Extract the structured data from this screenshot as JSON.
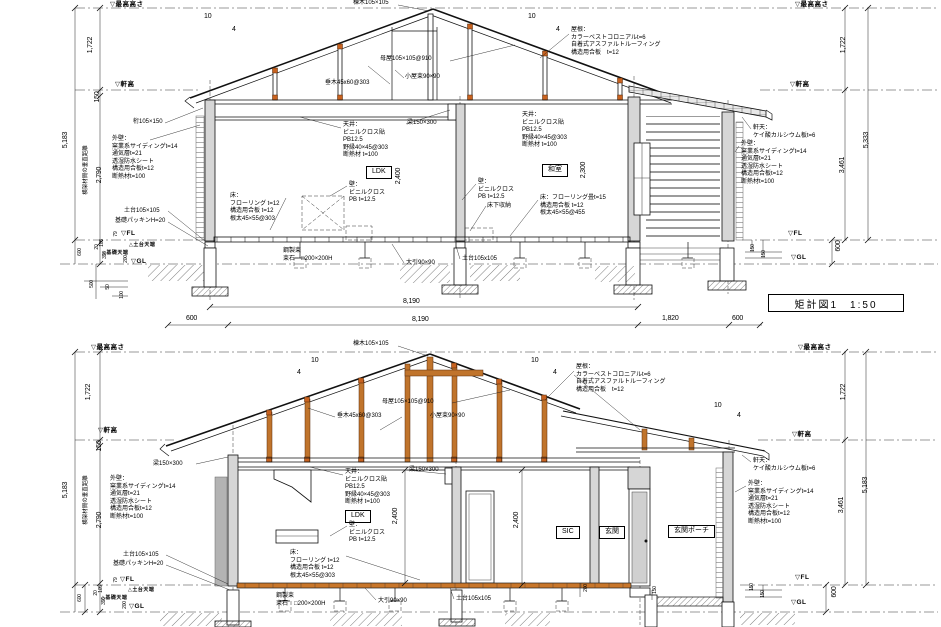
{
  "title_block": {
    "text": "矩計図1　1:50"
  },
  "labels": [
    {
      "n": "level-max-height-left",
      "t": "▽最高高さ",
      "x": 110,
      "y": 1,
      "cls": "level"
    },
    {
      "n": "level-max-height-right",
      "t": "▽最高高さ",
      "x": 795,
      "y": 1,
      "cls": "level"
    },
    {
      "n": "dim-vert",
      "t": "1,722",
      "x": 87,
      "y": 45,
      "rot": 1,
      "cls": "dim"
    },
    {
      "n": "dim-vert",
      "t": "1,722",
      "x": 840,
      "y": 45,
      "rot": 1,
      "cls": "dim"
    },
    {
      "n": "level-eave-left",
      "t": "▽軒高",
      "x": 115,
      "y": 81,
      "cls": "level"
    },
    {
      "n": "level-eave-right",
      "t": "▽軒高",
      "x": 790,
      "y": 81,
      "cls": "level"
    },
    {
      "n": "dim-vert",
      "t": "150",
      "x": 94,
      "y": 97,
      "rot": 1,
      "cls": "dim"
    },
    {
      "n": "dim-vert",
      "t": "5,183",
      "x": 62,
      "y": 140,
      "rot": 1,
      "cls": "dim"
    },
    {
      "n": "note-vert-member-distance",
      "t": "横架材間の垂直距離",
      "x": 83,
      "y": 170,
      "rot": 1,
      "cls": "note",
      "fs": 5.5
    },
    {
      "n": "dim-vert",
      "t": "2,790",
      "x": 96,
      "y": 175,
      "rot": 1,
      "cls": "dim"
    },
    {
      "n": "note-ridge",
      "t": "棟木105×105",
      "x": 353,
      "y": 0,
      "cls": "note"
    },
    {
      "n": "slope-mark",
      "t": "10",
      "x": 204,
      "y": 13,
      "cls": "dim"
    },
    {
      "n": "slope-mark",
      "t": "4",
      "x": 232,
      "y": 26,
      "cls": "dim"
    },
    {
      "n": "slope-mark",
      "t": "10",
      "x": 528,
      "y": 13,
      "cls": "dim"
    },
    {
      "n": "slope-mark",
      "t": "4",
      "x": 556,
      "y": 26,
      "cls": "dim"
    },
    {
      "n": "note-rafter",
      "t": "垂木45x60@303",
      "x": 325,
      "y": 80,
      "cls": "note"
    },
    {
      "n": "note-purlin",
      "t": "母屋105×105@910",
      "x": 380,
      "y": 56,
      "cls": "note"
    },
    {
      "n": "note-roof-post",
      "t": "小屋束90×90",
      "x": 405,
      "y": 74,
      "cls": "note"
    },
    {
      "n": "note-roof-spec",
      "t": "屋根：\nカラーベストコロニアルt=6\n自着式アスファルトルーフィング\n構造用合板　t=12",
      "x": 571,
      "y": 27,
      "cls": "note"
    },
    {
      "n": "note-girder",
      "t": "桁105×150",
      "x": 133,
      "y": 119,
      "cls": "note"
    },
    {
      "n": "note-exterior-wall-left",
      "t": "外壁：\n窯業系サイディングt=14\n通気層t=21\n透湿防水シート\n構造用合板t=12\n断熱材t=100",
      "x": 112,
      "y": 136,
      "cls": "note"
    },
    {
      "n": "note-ceiling-ldk",
      "t": "天井：\nビニルクロス貼\nPB12.5\n野縁40×45@303\n断熱材 t=100",
      "x": 343,
      "y": 122,
      "cls": "note"
    },
    {
      "n": "note-beam",
      "t": "梁150×300",
      "x": 407,
      "y": 120,
      "cls": "note"
    },
    {
      "n": "room-label-ldk",
      "t": "LDK",
      "x": 366,
      "y": 166,
      "cls": "room"
    },
    {
      "n": "note-wall-ldk",
      "t": "壁：\nビニルクロス\nPB t=12.5",
      "x": 349,
      "y": 182,
      "cls": "note"
    },
    {
      "n": "dim-vert",
      "t": "2,400",
      "x": 395,
      "y": 176,
      "rot": 1,
      "cls": "dim"
    },
    {
      "n": "note-floor-ldk",
      "t": "床：\nフローリング t=12\n構造用合板 t=12\n根太45×55@303",
      "x": 230,
      "y": 193,
      "cls": "note"
    },
    {
      "n": "note-ceiling-washitsu",
      "t": "天井：\nビニルクロス貼\nPB12.5\n野縁40×45@303\n断熱材 t=100",
      "x": 522,
      "y": 112,
      "cls": "note"
    },
    {
      "n": "room-label-washitsu",
      "t": "和室",
      "x": 542,
      "y": 164,
      "cls": "room"
    },
    {
      "n": "dim-vert",
      "t": "2,300",
      "x": 580,
      "y": 170,
      "rot": 1,
      "cls": "dim"
    },
    {
      "n": "note-wall-washitsu",
      "t": "壁：\nビニルクロス\nPB t=12.5",
      "x": 478,
      "y": 179,
      "cls": "note"
    },
    {
      "n": "note-underfloor-storage",
      "t": "床下収納",
      "x": 487,
      "y": 203,
      "cls": "note"
    },
    {
      "n": "note-floor-washitsu",
      "t": "床：フローリング畳t=15\n構造用合板 t=12\n根太45×55@455",
      "x": 540,
      "y": 195,
      "cls": "note"
    },
    {
      "n": "note-eave-soffit-right",
      "t": "軒天：\nケイ酸カルシウム板t=6",
      "x": 753,
      "y": 125,
      "cls": "note"
    },
    {
      "n": "note-exterior-wall-right",
      "t": "外壁：\n窯業系サイディングt=14\n通気層t=21\n透湿防水シート\n構造用合板t=12\n断熱材t=100",
      "x": 741,
      "y": 141,
      "cls": "note"
    },
    {
      "n": "note-sill",
      "t": "土台105×105",
      "x": 124,
      "y": 208,
      "cls": "note"
    },
    {
      "n": "note-foundation-packing",
      "t": "基礎パッキンH=20",
      "x": 115,
      "y": 218,
      "cls": "note"
    },
    {
      "n": "level-fl-left",
      "t": "▽FL",
      "x": 121,
      "y": 230,
      "cls": "level"
    },
    {
      "n": "level-sill-top",
      "t": "△土台天端",
      "x": 129,
      "y": 242,
      "cls": "level",
      "fs": 5
    },
    {
      "n": "level-foundation-top",
      "t": "△基礎天端",
      "x": 102,
      "y": 250,
      "cls": "level",
      "fs": 5
    },
    {
      "n": "level-gl-left",
      "t": "▽GL",
      "x": 131,
      "y": 258,
      "cls": "level"
    },
    {
      "n": "dim-vert",
      "t": "79",
      "x": 113,
      "y": 234,
      "rot": 1,
      "cls": "dim",
      "fs": 5
    },
    {
      "n": "dim-vert",
      "t": "105",
      "x": 99,
      "y": 243,
      "rot": 1,
      "cls": "dim",
      "fs": 5
    },
    {
      "n": "dim-vert",
      "t": "20",
      "x": 94,
      "y": 247,
      "rot": 1,
      "cls": "dim",
      "fs": 5
    },
    {
      "n": "dim-vert",
      "t": "396",
      "x": 102,
      "y": 255,
      "rot": 1,
      "cls": "dim",
      "fs": 5
    },
    {
      "n": "dim-vert",
      "t": "600",
      "x": 77,
      "y": 252,
      "rot": 1,
      "cls": "dim",
      "fs": 5
    },
    {
      "n": "dim-vert",
      "t": "200",
      "x": 123,
      "y": 259,
      "rot": 1,
      "cls": "dim",
      "fs": 5
    },
    {
      "n": "dim-vert",
      "t": "500",
      "x": 89,
      "y": 284,
      "rot": 1,
      "cls": "dim",
      "fs": 5
    },
    {
      "n": "dim-vert",
      "t": "50",
      "x": 105,
      "y": 287,
      "rot": 1,
      "cls": "dim",
      "fs": 5
    },
    {
      "n": "dim-vert",
      "t": "100",
      "x": 119,
      "y": 295,
      "rot": 1,
      "cls": "dim",
      "fs": 5
    },
    {
      "n": "note-steel-post",
      "t": "鋼製束",
      "x": 283,
      "y": 248,
      "cls": "note"
    },
    {
      "n": "note-post-stone",
      "t": "束石　□200×200H",
      "x": 283,
      "y": 256,
      "cls": "note"
    },
    {
      "n": "note-sleeper",
      "t": "大引90×90",
      "x": 406,
      "y": 260,
      "cls": "note"
    },
    {
      "n": "note-sill-center",
      "t": "土台105x105",
      "x": 462,
      "y": 256,
      "cls": "note"
    },
    {
      "n": "level-fl-right",
      "t": "▽FL",
      "x": 788,
      "y": 230,
      "cls": "level"
    },
    {
      "n": "level-gl-right",
      "t": "▽GL",
      "x": 791,
      "y": 254,
      "cls": "level"
    },
    {
      "n": "dim-vert",
      "t": "600",
      "x": 835,
      "y": 246,
      "rot": 1,
      "cls": "dim"
    },
    {
      "n": "dim-vert",
      "t": "150",
      "x": 750,
      "y": 248,
      "rot": 1,
      "cls": "dim",
      "fs": 5
    },
    {
      "n": "dim-vert",
      "t": "150",
      "x": 761,
      "y": 254,
      "rot": 1,
      "cls": "dim",
      "fs": 5
    },
    {
      "n": "dim-vert",
      "t": "5,333",
      "x": 863,
      "y": 140,
      "rot": 1,
      "cls": "dim"
    },
    {
      "n": "dim-vert",
      "t": "3,461",
      "x": 839,
      "y": 165,
      "rot": 1,
      "cls": "dim"
    },
    {
      "n": "dim-horiz",
      "t": "8,190",
      "x": 403,
      "y": 298,
      "cls": "dim"
    },
    {
      "n": "dim-horiz",
      "t": "600",
      "x": 186,
      "y": 315,
      "cls": "dim"
    },
    {
      "n": "dim-horiz",
      "t": "8,190",
      "x": 412,
      "y": 316,
      "cls": "dim"
    },
    {
      "n": "dim-horiz",
      "t": "1,820",
      "x": 662,
      "y": 315,
      "cls": "dim"
    },
    {
      "n": "dim-horiz",
      "t": "600",
      "x": 732,
      "y": 315,
      "cls": "dim"
    },
    {
      "n": "note-ridge",
      "t": "棟木105×105",
      "x": 353,
      "y": 341,
      "cls": "note"
    },
    {
      "n": "level-max-height-left",
      "t": "▽最高高さ",
      "x": 91,
      "y": 344,
      "cls": "level"
    },
    {
      "n": "level-max-height-right",
      "t": "▽最高高さ",
      "x": 798,
      "y": 344,
      "cls": "level"
    },
    {
      "n": "dim-vert",
      "t": "1,722",
      "x": 85,
      "y": 392,
      "rot": 1,
      "cls": "dim"
    },
    {
      "n": "dim-vert",
      "t": "1,722",
      "x": 840,
      "y": 392,
      "rot": 1,
      "cls": "dim"
    },
    {
      "n": "level-eave-left",
      "t": "▽軒高",
      "x": 98,
      "y": 427,
      "cls": "level"
    },
    {
      "n": "level-eave-right",
      "t": "▽軒高",
      "x": 792,
      "y": 431,
      "cls": "level"
    },
    {
      "n": "dim-vert",
      "t": "150",
      "x": 96,
      "y": 446,
      "rot": 1,
      "cls": "dim"
    },
    {
      "n": "dim-vert",
      "t": "5,183",
      "x": 62,
      "y": 490,
      "rot": 1,
      "cls": "dim"
    },
    {
      "n": "dim-vert",
      "t": "5,183",
      "x": 862,
      "y": 485,
      "rot": 1,
      "cls": "dim"
    },
    {
      "n": "dim-vert",
      "t": "3,461",
      "x": 838,
      "y": 505,
      "rot": 1,
      "cls": "dim"
    },
    {
      "n": "note-vert-member-distance",
      "t": "横架材間の垂直距離",
      "x": 83,
      "y": 500,
      "rot": 1,
      "cls": "note",
      "fs": 5.5
    },
    {
      "n": "dim-vert",
      "t": "2,790",
      "x": 96,
      "y": 520,
      "rot": 1,
      "cls": "dim"
    },
    {
      "n": "slope-mark",
      "t": "10",
      "x": 311,
      "y": 357,
      "cls": "dim"
    },
    {
      "n": "slope-mark",
      "t": "4",
      "x": 297,
      "y": 369,
      "cls": "dim"
    },
    {
      "n": "slope-mark",
      "t": "10",
      "x": 531,
      "y": 357,
      "cls": "dim"
    },
    {
      "n": "slope-mark",
      "t": "4",
      "x": 553,
      "y": 369,
      "cls": "dim"
    },
    {
      "n": "slope-mark",
      "t": "10",
      "x": 714,
      "y": 402,
      "cls": "dim"
    },
    {
      "n": "slope-mark",
      "t": "4",
      "x": 737,
      "y": 412,
      "cls": "dim"
    },
    {
      "n": "note-purlin",
      "t": "母屋105×105@910",
      "x": 382,
      "y": 399,
      "cls": "note"
    },
    {
      "n": "note-rafter",
      "t": "垂木45x60@303",
      "x": 337,
      "y": 413,
      "cls": "note"
    },
    {
      "n": "note-roof-post",
      "t": "小屋束90×90",
      "x": 430,
      "y": 413,
      "cls": "note"
    },
    {
      "n": "note-roof-spec",
      "t": "屋根：\nカラーベストコロニアルt=6\n自着式アスファルトルーフィング\n構造用合板　t=12",
      "x": 576,
      "y": 364,
      "cls": "note"
    },
    {
      "n": "note-beam",
      "t": "梁150×300",
      "x": 153,
      "y": 461,
      "cls": "note"
    },
    {
      "n": "note-beam",
      "t": "梁150×300",
      "x": 409,
      "y": 467,
      "cls": "note"
    },
    {
      "n": "note-ceiling-ldk",
      "t": "天井：\nビニルクロス貼\nPB12.5\n野縁40×45@303\n断熱材 t=100",
      "x": 345,
      "y": 469,
      "cls": "note"
    },
    {
      "n": "room-label-ldk",
      "t": "LDK",
      "x": 345,
      "y": 510,
      "cls": "room"
    },
    {
      "n": "dim-vert",
      "t": "2,400",
      "x": 392,
      "y": 516,
      "rot": 1,
      "cls": "dim"
    },
    {
      "n": "dim-vert",
      "t": "2,400",
      "x": 513,
      "y": 520,
      "rot": 1,
      "cls": "dim"
    },
    {
      "n": "note-wall-ldk",
      "t": "壁：\nビニルクロス\nPB t=12.5",
      "x": 349,
      "y": 522,
      "cls": "note"
    },
    {
      "n": "note-floor-ldk",
      "t": "床：\nフローリング t=12\n構造用合板 t=12\n根太45×55@303",
      "x": 290,
      "y": 550,
      "cls": "note"
    },
    {
      "n": "room-label-sic",
      "t": "SIC",
      "x": 556,
      "y": 526,
      "cls": "room"
    },
    {
      "n": "room-label-genkan",
      "t": "玄関",
      "x": 599,
      "y": 526,
      "cls": "room"
    },
    {
      "n": "room-label-porch",
      "t": "玄関ポーチ",
      "x": 668,
      "y": 525,
      "cls": "room"
    },
    {
      "n": "note-eave-soffit-right",
      "t": "軒天：\nケイ酸カルシウム板t=6",
      "x": 753,
      "y": 458,
      "cls": "note"
    },
    {
      "n": "note-exterior-wall-right",
      "t": "外壁：\n窯業系サイディングt=14\n通気層t=21\n透湿防水シート\n構造用合板t=12\n断熱材t=100",
      "x": 748,
      "y": 481,
      "cls": "note"
    },
    {
      "n": "note-exterior-wall-left",
      "t": "外壁：\n窯業系サイディングt=14\n通気層t=21\n透湿防水シート\n構造用合板t=12\n断熱材t=100",
      "x": 110,
      "y": 476,
      "cls": "note"
    },
    {
      "n": "note-sill",
      "t": "土台105×105",
      "x": 123,
      "y": 552,
      "cls": "note"
    },
    {
      "n": "note-foundation-packing",
      "t": "基礎パッキンH=20",
      "x": 113,
      "y": 561,
      "cls": "note"
    },
    {
      "n": "level-fl-left",
      "t": "▽FL",
      "x": 120,
      "y": 576,
      "cls": "level"
    },
    {
      "n": "level-sill-top",
      "t": "△土台天端",
      "x": 128,
      "y": 587,
      "cls": "level",
      "fs": 5
    },
    {
      "n": "level-foundation-top",
      "t": "△基礎天端",
      "x": 101,
      "y": 595,
      "cls": "level",
      "fs": 5
    },
    {
      "n": "level-gl-left",
      "t": "▽GL",
      "x": 129,
      "y": 603,
      "cls": "level"
    },
    {
      "n": "dim-vert",
      "t": "79",
      "x": 113,
      "y": 580,
      "rot": 1,
      "cls": "dim",
      "fs": 5
    },
    {
      "n": "dim-vert",
      "t": "105",
      "x": 98,
      "y": 589,
      "rot": 1,
      "cls": "dim",
      "fs": 5
    },
    {
      "n": "dim-vert",
      "t": "20",
      "x": 93,
      "y": 593,
      "rot": 1,
      "cls": "dim",
      "fs": 5
    },
    {
      "n": "dim-vert",
      "t": "396",
      "x": 101,
      "y": 601,
      "rot": 1,
      "cls": "dim",
      "fs": 5
    },
    {
      "n": "dim-vert",
      "t": "600",
      "x": 77,
      "y": 598,
      "rot": 1,
      "cls": "dim",
      "fs": 5
    },
    {
      "n": "dim-vert",
      "t": "200",
      "x": 122,
      "y": 605,
      "rot": 1,
      "cls": "dim",
      "fs": 5
    },
    {
      "n": "note-steel-post",
      "t": "鋼製束",
      "x": 276,
      "y": 593,
      "cls": "note"
    },
    {
      "n": "note-post-stone",
      "t": "束石　□200×200H",
      "x": 276,
      "y": 601,
      "cls": "note"
    },
    {
      "n": "note-sleeper",
      "t": "大引90×90",
      "x": 378,
      "y": 598,
      "cls": "note"
    },
    {
      "n": "note-sill-center",
      "t": "土台105x105",
      "x": 456,
      "y": 596,
      "cls": "note"
    },
    {
      "n": "level-fl-right",
      "t": "▽FL",
      "x": 795,
      "y": 574,
      "cls": "level"
    },
    {
      "n": "level-gl-right",
      "t": "▽GL",
      "x": 791,
      "y": 599,
      "cls": "level"
    },
    {
      "n": "dim-vert",
      "t": "600",
      "x": 831,
      "y": 592,
      "rot": 1,
      "cls": "dim"
    },
    {
      "n": "dim-vert",
      "t": "150",
      "x": 749,
      "y": 587,
      "rot": 1,
      "cls": "dim",
      "fs": 5
    },
    {
      "n": "dim-vert",
      "t": "150",
      "x": 760,
      "y": 594,
      "rot": 1,
      "cls": "dim",
      "fs": 5
    },
    {
      "n": "dim-vert",
      "t": "200",
      "x": 583,
      "y": 588,
      "rot": 1,
      "cls": "dim",
      "fs": 5
    },
    {
      "n": "dim-vert",
      "t": "150",
      "x": 652,
      "y": 590,
      "rot": 1,
      "cls": "dim",
      "fs": 5
    }
  ]
}
